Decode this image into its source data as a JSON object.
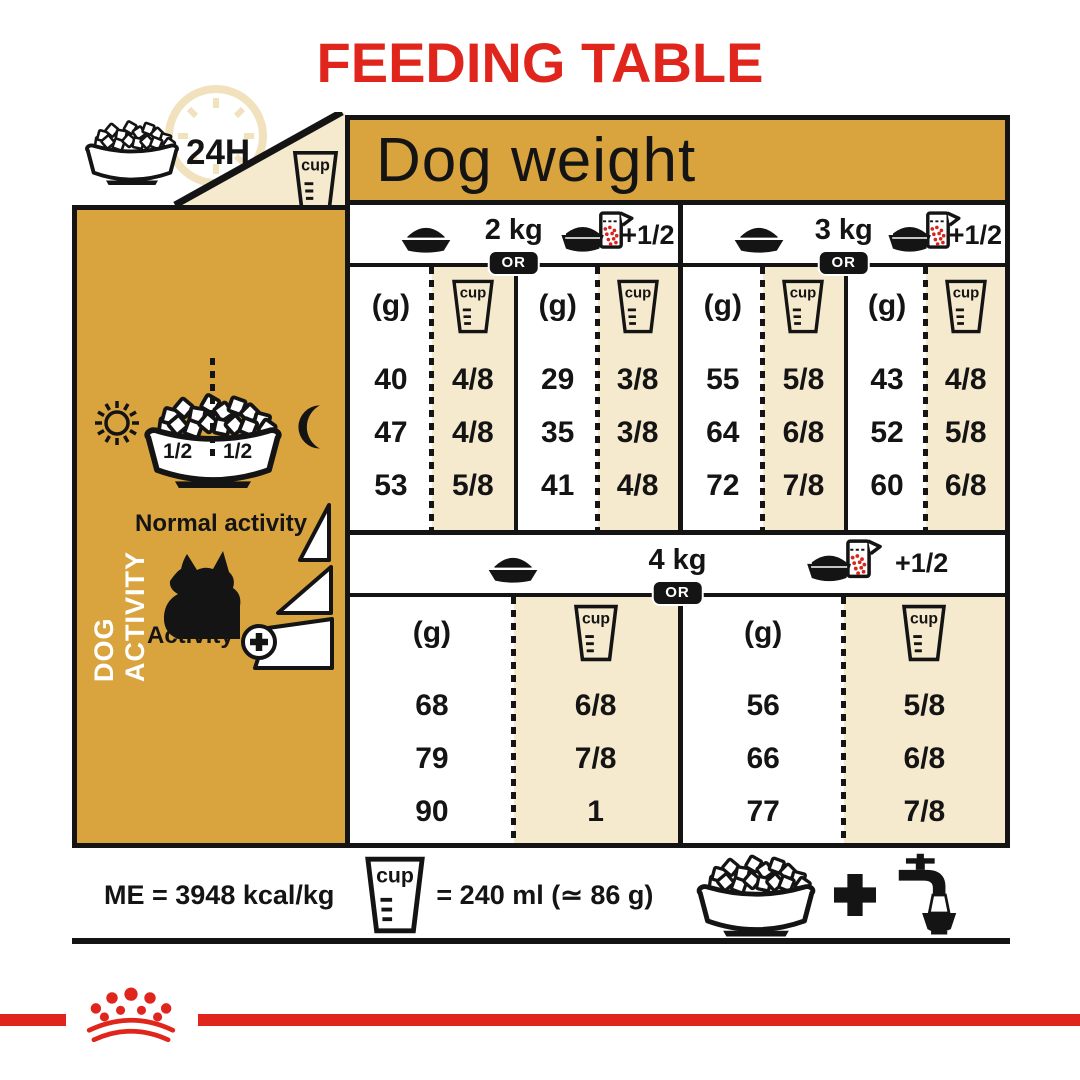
{
  "title": "FEEDING TABLE",
  "table": {
    "corner": {
      "duration": "24H"
    },
    "dog_weight_header": "Dog weight",
    "or_label": "OR",
    "grams_label": "(g)",
    "cup_label": "cup",
    "plus_half_label": "+1/2",
    "sections": [
      {
        "weights": [
          {
            "label": "2 kg",
            "columns": [
              {
                "rows": [
                  {
                    "g": "40",
                    "cup": "4/8"
                  },
                  {
                    "g": "47",
                    "cup": "4/8"
                  },
                  {
                    "g": "53",
                    "cup": "5/8"
                  }
                ]
              },
              {
                "rows": [
                  {
                    "g": "29",
                    "cup": "3/8"
                  },
                  {
                    "g": "35",
                    "cup": "3/8"
                  },
                  {
                    "g": "41",
                    "cup": "4/8"
                  }
                ]
              }
            ]
          },
          {
            "label": "3 kg",
            "columns": [
              {
                "rows": [
                  {
                    "g": "55",
                    "cup": "5/8"
                  },
                  {
                    "g": "64",
                    "cup": "6/8"
                  },
                  {
                    "g": "72",
                    "cup": "7/8"
                  }
                ]
              },
              {
                "rows": [
                  {
                    "g": "43",
                    "cup": "4/8"
                  },
                  {
                    "g": "52",
                    "cup": "5/8"
                  },
                  {
                    "g": "60",
                    "cup": "6/8"
                  }
                ]
              }
            ]
          }
        ]
      },
      {
        "weights": [
          {
            "label": "4 kg",
            "columns": [
              {
                "rows": [
                  {
                    "g": "68",
                    "cup": "6/8"
                  },
                  {
                    "g": "79",
                    "cup": "7/8"
                  },
                  {
                    "g": "90",
                    "cup": "1"
                  }
                ]
              },
              {
                "rows": [
                  {
                    "g": "56",
                    "cup": "5/8"
                  },
                  {
                    "g": "66",
                    "cup": "6/8"
                  },
                  {
                    "g": "77",
                    "cup": "7/8"
                  }
                ]
              }
            ]
          }
        ]
      }
    ]
  },
  "sidebar": {
    "title": "DOG ACTIVITY",
    "half_label": "1/2",
    "normal_activity": "Normal activity",
    "activity": "Activity"
  },
  "footer": {
    "me_text": "ME = 3948 kcal/kg",
    "cup_equivalence": "= 240 ml (≃ 86 g)"
  },
  "colors": {
    "brand_red": "#e0251c",
    "gold": "#d9a43e",
    "cream": "#f5e9ce",
    "black": "#141414"
  }
}
